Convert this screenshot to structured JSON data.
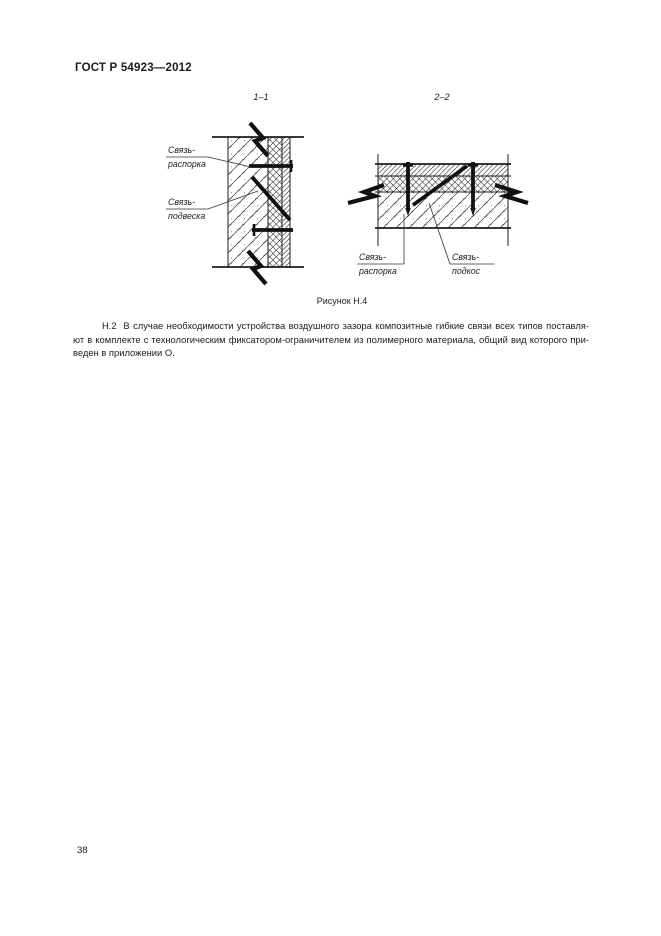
{
  "header": {
    "title": "ГОСТ Р 54923—2012"
  },
  "figure": {
    "caption": "Рисунок Н.4",
    "left_section": {
      "title": "1–1",
      "label_spacer": {
        "line1": "Связь-",
        "line2": "распорка"
      },
      "label_hanger": {
        "line1": "Связь-",
        "line2": "подвеска"
      }
    },
    "right_section": {
      "title": "2–2",
      "label_spacer": {
        "line1": "Связь-",
        "line2": "распорка"
      },
      "label_strut": {
        "line1": "Связь-",
        "line2": "подкос"
      }
    }
  },
  "body_text": {
    "lines": [
      "Н.2  В случае необходимости устройства воздушного зазора композитные гибкие связи всех типов поставля-",
      "ют в комплекте с технологическим фиксатором-ограничителем из полимерного материала, общий вид которого при-",
      "веден в приложении О."
    ]
  },
  "footer": {
    "page_number": "38"
  },
  "colors": {
    "ink": "#1c1c1c",
    "paper": "#ffffff"
  }
}
